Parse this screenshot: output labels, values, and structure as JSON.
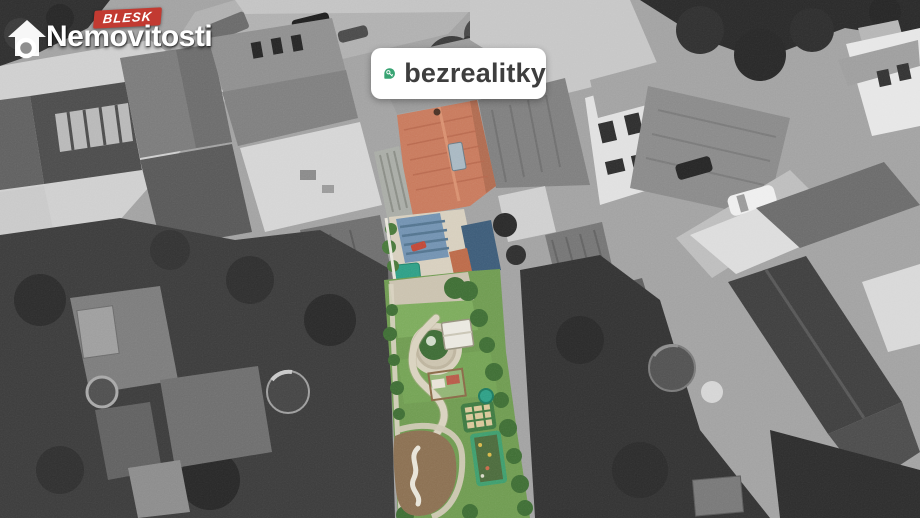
{
  "overlays": {
    "blesk_logo": {
      "badge_label": "BLESK",
      "brand_name": "Nemovitosti",
      "badge_color": "#c23a31",
      "text_color": "#ffffff"
    },
    "bezrealitky_badge": {
      "label": "bezrealitky",
      "background": "#ffffff",
      "pin_color": "#38a473",
      "text_color": "#3e3e3e"
    }
  },
  "photo": {
    "style": "aerial drone photo; neighborhood desaturated to grayscale, listed property shown in color",
    "highlighted_property": {
      "roof_color": "#c87a5d",
      "roof_skylight_color": "#a8b8c2",
      "courtyard_color": "#d7cfbe",
      "pergola_color": "#7292b1",
      "pool_color": "#2f9f86",
      "lawn_color": "#6f9b51",
      "path_color": "#d9d2bf",
      "soil_color": "#8b7052",
      "hedge_color": "#3f6e35",
      "shed_roof_color": "#3d5c79"
    }
  }
}
